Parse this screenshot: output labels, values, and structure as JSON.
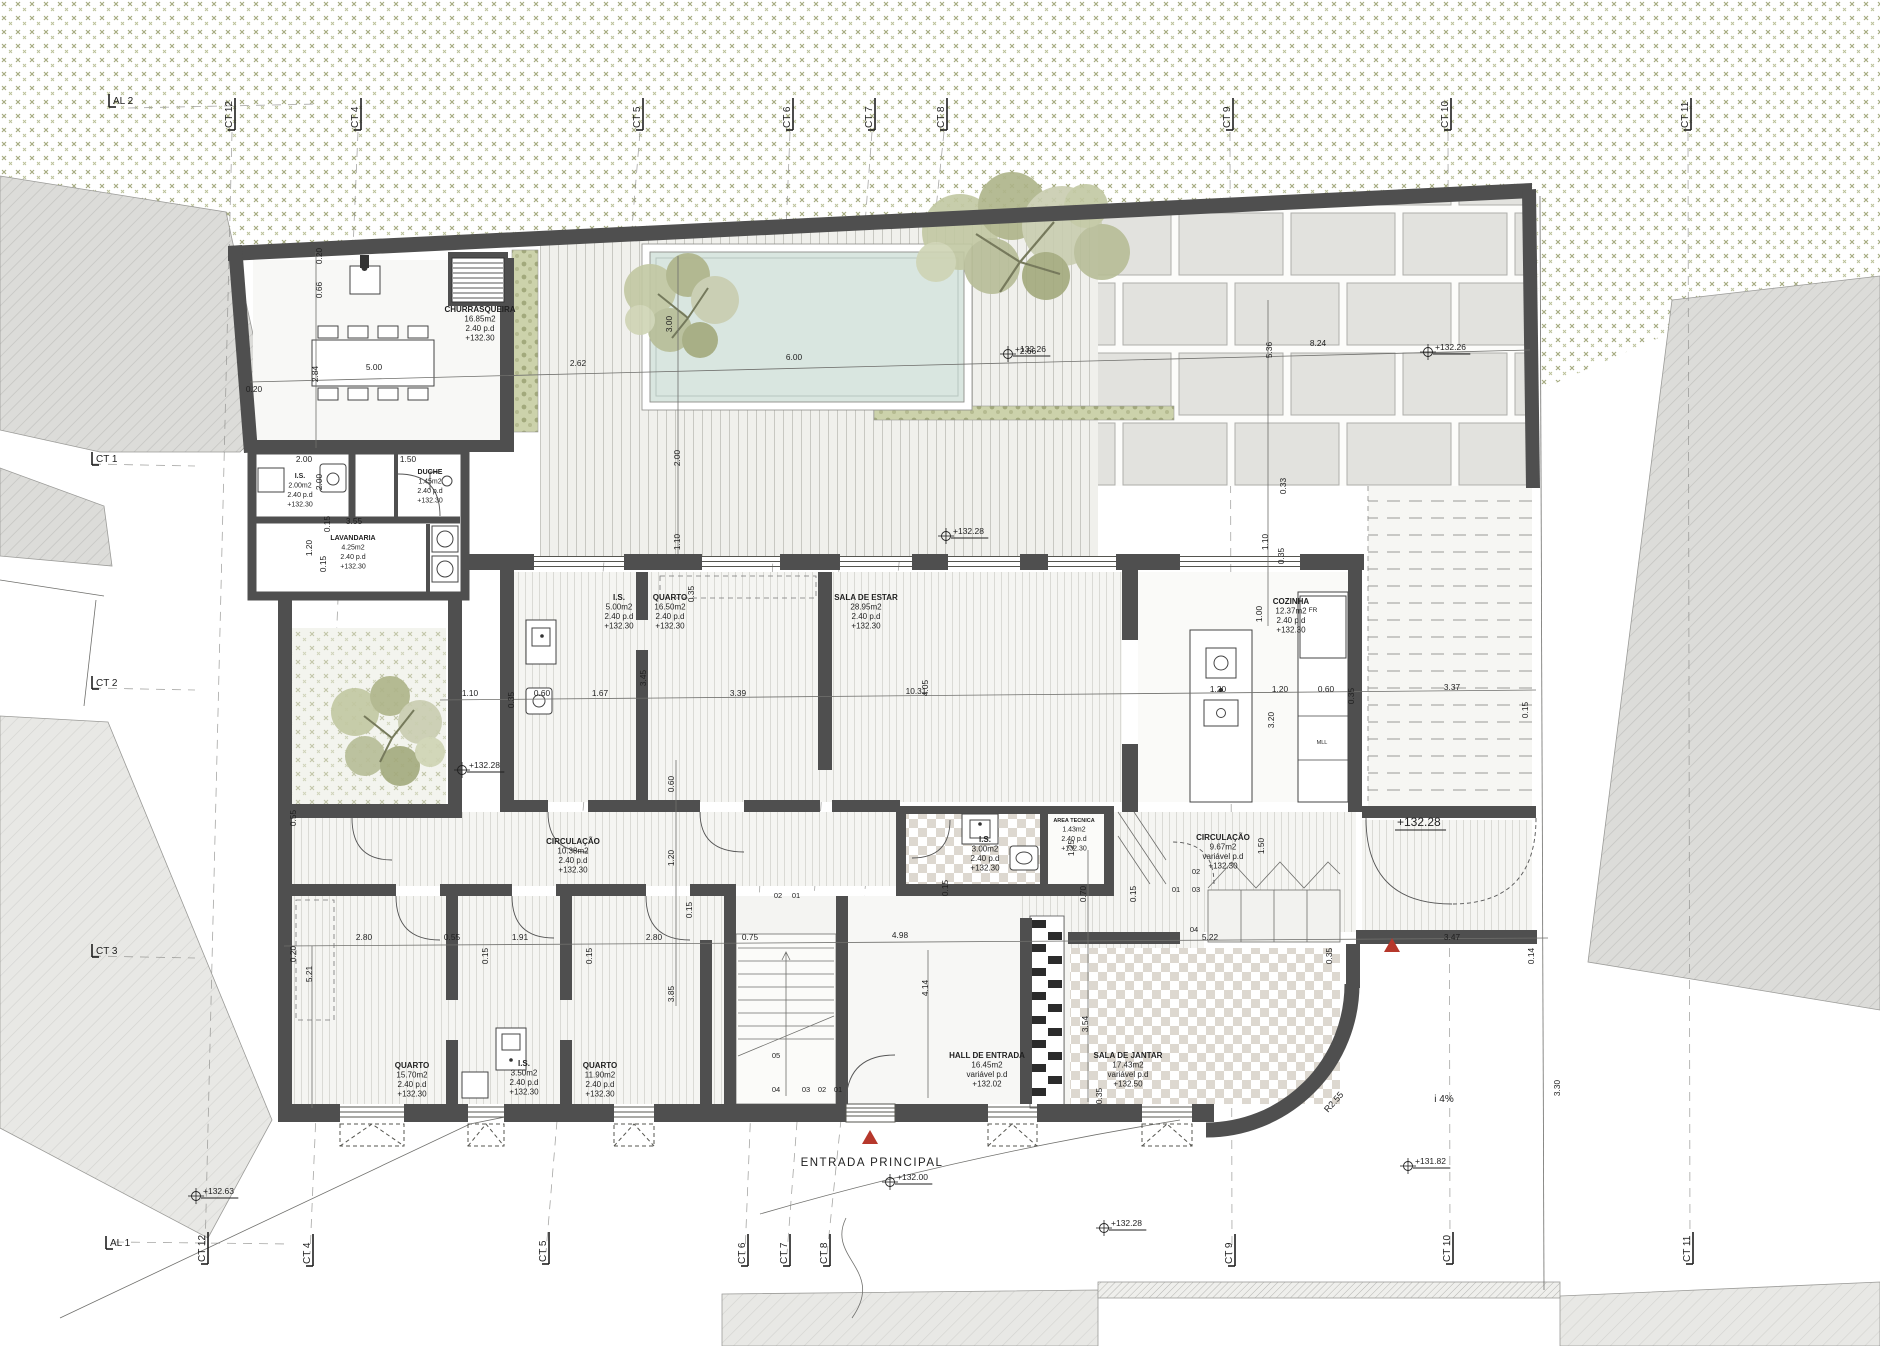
{
  "colors": {
    "vegetation": "#9ba172",
    "wall": "#4f4f4f",
    "pool": "#d9e6e0",
    "paving": "#e2e2de",
    "marker_red": "#b6372b",
    "text": "#1f1f1f"
  },
  "rooms": [
    {
      "name": "CHURRASQUEIRA",
      "area": "16.85m2",
      "height": "2.40 p.d",
      "level": "+132.30",
      "x": 480,
      "y": 312
    },
    {
      "name": "I.S.",
      "area": "2.00m2",
      "height": "2.40 p.d",
      "level": "+132.30",
      "x": 300,
      "y": 478,
      "small": true
    },
    {
      "name": "DUCHE",
      "area": "1.45m2",
      "height": "2.40 p.d",
      "level": "+132.30",
      "x": 430,
      "y": 474,
      "small": true
    },
    {
      "name": "LAVANDARIA",
      "area": "4.25m2",
      "height": "2.40 p.d",
      "level": "+132.30",
      "x": 353,
      "y": 540,
      "small": true
    },
    {
      "name": "I.S.",
      "area": "5.00m2",
      "height": "2.40 p.d",
      "level": "+132.30",
      "x": 619,
      "y": 600
    },
    {
      "name": "QUARTO",
      "area": "16.50m2",
      "height": "2.40 p.d",
      "level": "+132.30",
      "x": 670,
      "y": 600
    },
    {
      "name": "SALA DE ESTAR",
      "area": "28.95m2",
      "height": "2.40 p.d",
      "level": "+132.30",
      "x": 866,
      "y": 600
    },
    {
      "name": "COZINHA",
      "area": "12.37m2",
      "height": "2.40 p.d",
      "level": "+132.30",
      "x": 1291,
      "y": 604
    },
    {
      "name": "CIRCULAÇÃO",
      "area": "10.38m2",
      "height": "2.40 p.d",
      "level": "+132.30",
      "x": 573,
      "y": 844
    },
    {
      "name": "I.S.",
      "area": "3.00m2",
      "height": "2.40 p.d",
      "level": "+132.30",
      "x": 985,
      "y": 842
    },
    {
      "name": "AREA TECNICA",
      "area": "1.43m2",
      "height": "2.40 p.d",
      "level": "+132.30",
      "x": 1074,
      "y": 822,
      "small": true
    },
    {
      "name": "CIRCULAÇÃO",
      "area": "9.67m2",
      "height": "variável p.d",
      "level": "+132.30",
      "x": 1223,
      "y": 840
    },
    {
      "name": "QUARTO",
      "area": "15.70m2",
      "height": "2.40 p.d",
      "level": "+132.30",
      "x": 412,
      "y": 1068
    },
    {
      "name": "I.S.",
      "area": "3.50m2",
      "height": "2.40 p.d",
      "level": "+132.30",
      "x": 524,
      "y": 1066
    },
    {
      "name": "QUARTO",
      "area": "11.90m2",
      "height": "2.40 p.d",
      "level": "+132.30",
      "x": 600,
      "y": 1068
    },
    {
      "name": "HALL DE ENTRADA",
      "area": "16.45m2",
      "height": "variável p.d",
      "level": "+132.02",
      "x": 987,
      "y": 1058
    },
    {
      "name": "SALA DE JANTAR",
      "area": "17.43m2",
      "height": "variável p.d",
      "level": "+132.50",
      "x": 1128,
      "y": 1058
    }
  ],
  "grid_labels": [
    {
      "t": "AL 2",
      "x": 113,
      "y": 104,
      "o": "h"
    },
    {
      "t": "CT 12",
      "x": 232,
      "y": 128,
      "o": "v"
    },
    {
      "t": "CT 4",
      "x": 358,
      "y": 128,
      "o": "v"
    },
    {
      "t": "CT 5",
      "x": 640,
      "y": 128,
      "o": "v"
    },
    {
      "t": "CT 6",
      "x": 790,
      "y": 128,
      "o": "v"
    },
    {
      "t": "CT 7",
      "x": 872,
      "y": 128,
      "o": "v"
    },
    {
      "t": "CT 8",
      "x": 944,
      "y": 128,
      "o": "v"
    },
    {
      "t": "CT 9",
      "x": 1230,
      "y": 128,
      "o": "v"
    },
    {
      "t": "CT 10",
      "x": 1448,
      "y": 128,
      "o": "v"
    },
    {
      "t": "CT 11",
      "x": 1688,
      "y": 128,
      "o": "v"
    },
    {
      "t": "CT 1",
      "x": 96,
      "y": 462,
      "o": "h"
    },
    {
      "t": "CT 2",
      "x": 96,
      "y": 686,
      "o": "h"
    },
    {
      "t": "CT 3",
      "x": 96,
      "y": 954,
      "o": "h"
    },
    {
      "t": "AL 1",
      "x": 110,
      "y": 1246,
      "o": "h"
    },
    {
      "t": "CT 12",
      "x": 205,
      "y": 1262,
      "o": "v"
    },
    {
      "t": "CT 4",
      "x": 310,
      "y": 1264,
      "o": "v"
    },
    {
      "t": "CT 5",
      "x": 546,
      "y": 1262,
      "o": "v"
    },
    {
      "t": "CT 6",
      "x": 745,
      "y": 1264,
      "o": "v"
    },
    {
      "t": "CT 7",
      "x": 787,
      "y": 1264,
      "o": "v"
    },
    {
      "t": "CT 8",
      "x": 827,
      "y": 1264,
      "o": "v"
    },
    {
      "t": "CT 9",
      "x": 1232,
      "y": 1264,
      "o": "v"
    },
    {
      "t": "CT 10",
      "x": 1450,
      "y": 1262,
      "o": "v"
    },
    {
      "t": "CT 11",
      "x": 1690,
      "y": 1262,
      "o": "v"
    }
  ],
  "elevations": [
    {
      "t": "+132.26",
      "x": 1008,
      "y": 354
    },
    {
      "t": "+132.26",
      "x": 1428,
      "y": 352
    },
    {
      "t": "+132.28",
      "x": 946,
      "y": 536
    },
    {
      "t": "+132.28",
      "x": 462,
      "y": 770
    },
    {
      "t": "+132.28",
      "x": 1390,
      "y": 828,
      "big": true
    },
    {
      "t": "+132.63",
      "x": 196,
      "y": 1196
    },
    {
      "t": "+132.00",
      "x": 890,
      "y": 1182
    },
    {
      "t": "+132.28",
      "x": 1104,
      "y": 1228
    },
    {
      "t": "+131.82",
      "x": 1408,
      "y": 1166
    }
  ],
  "annotations": [
    {
      "t": "ENTRADA PRINCIPAL",
      "x": 872,
      "y": 1166,
      "s": 11.5,
      "sp": 1.5
    },
    {
      "t": "i 4%",
      "x": 1444,
      "y": 1102,
      "s": 10
    },
    {
      "t": "R2.55",
      "x": 1336,
      "y": 1104,
      "s": 9,
      "r": -48
    },
    {
      "t": "FR",
      "x": 1313,
      "y": 612,
      "s": 6.5
    },
    {
      "t": "MLL",
      "x": 1322,
      "y": 744,
      "s": 5.5
    },
    {
      "t": "02",
      "x": 778,
      "y": 898,
      "s": 7.5
    },
    {
      "t": "01",
      "x": 796,
      "y": 898,
      "s": 7.5
    },
    {
      "t": "02",
      "x": 1196,
      "y": 874,
      "s": 7.5
    },
    {
      "t": "01",
      "x": 1176,
      "y": 892,
      "s": 7.5
    },
    {
      "t": "03",
      "x": 1196,
      "y": 892,
      "s": 7.5
    },
    {
      "t": "05",
      "x": 776,
      "y": 1058,
      "s": 7.5
    },
    {
      "t": "04",
      "x": 776,
      "y": 1092,
      "s": 7.5
    },
    {
      "t": "03",
      "x": 806,
      "y": 1092,
      "s": 7.5
    },
    {
      "t": "02",
      "x": 822,
      "y": 1092,
      "s": 7.5
    },
    {
      "t": "01",
      "x": 838,
      "y": 1092,
      "s": 7.5
    },
    {
      "t": "04",
      "x": 1194,
      "y": 932,
      "s": 7.5
    }
  ],
  "dimensions": [
    {
      "t": "0.20",
      "x": 254,
      "y": 392
    },
    {
      "t": "5.00",
      "x": 374,
      "y": 370
    },
    {
      "t": "2.84",
      "x": 318,
      "y": 374,
      "r": -90
    },
    {
      "t": "2.62",
      "x": 578,
      "y": 366
    },
    {
      "t": "6.00",
      "x": 794,
      "y": 360
    },
    {
      "t": "2.66",
      "x": 1028,
      "y": 354
    },
    {
      "t": "8.24",
      "x": 1318,
      "y": 346
    },
    {
      "t": "0.20",
      "x": 322,
      "y": 256,
      "r": -90
    },
    {
      "t": "0.66",
      "x": 322,
      "y": 290,
      "r": -90
    },
    {
      "t": "3.00",
      "x": 672,
      "y": 324,
      "r": -90
    },
    {
      "t": "5.36",
      "x": 1272,
      "y": 350,
      "r": -90
    },
    {
      "t": "0.33",
      "x": 1286,
      "y": 486,
      "r": -90
    },
    {
      "t": "2.00",
      "x": 680,
      "y": 458,
      "r": -90
    },
    {
      "t": "1.10",
      "x": 680,
      "y": 542,
      "r": -90
    },
    {
      "t": "1.10",
      "x": 1268,
      "y": 542,
      "r": -90
    },
    {
      "t": "0.35",
      "x": 1284,
      "y": 556,
      "r": -90
    },
    {
      "t": "1.00",
      "x": 1262,
      "y": 614,
      "r": -90
    },
    {
      "t": "2.00",
      "x": 304,
      "y": 462
    },
    {
      "t": "1.50",
      "x": 408,
      "y": 462
    },
    {
      "t": "2.00",
      "x": 322,
      "y": 482,
      "r": -90
    },
    {
      "t": "3.55",
      "x": 354,
      "y": 524
    },
    {
      "t": "0.15",
      "x": 330,
      "y": 524,
      "r": -90
    },
    {
      "t": "1.20",
      "x": 312,
      "y": 548,
      "r": -90
    },
    {
      "t": "0.15",
      "x": 326,
      "y": 564,
      "r": -90
    },
    {
      "t": "1.10",
      "x": 470,
      "y": 696
    },
    {
      "t": "0.35",
      "x": 514,
      "y": 700,
      "r": -90
    },
    {
      "t": "0.60",
      "x": 542,
      "y": 696
    },
    {
      "t": "1.67",
      "x": 600,
      "y": 696
    },
    {
      "t": "3.45",
      "x": 646,
      "y": 678,
      "r": -90
    },
    {
      "t": "3.39",
      "x": 738,
      "y": 696
    },
    {
      "t": "10.31",
      "x": 916,
      "y": 694
    },
    {
      "t": "4.05",
      "x": 928,
      "y": 688,
      "r": -90
    },
    {
      "t": "1.20",
      "x": 1218,
      "y": 692
    },
    {
      "t": "1.20",
      "x": 1280,
      "y": 692
    },
    {
      "t": "0.60",
      "x": 1326,
      "y": 692
    },
    {
      "t": "0.35",
      "x": 1354,
      "y": 696,
      "r": -90
    },
    {
      "t": "3.37",
      "x": 1452,
      "y": 690
    },
    {
      "t": "0.15",
      "x": 1528,
      "y": 710,
      "r": -90
    },
    {
      "t": "3.20",
      "x": 1274,
      "y": 720,
      "r": -90
    },
    {
      "t": "0.35",
      "x": 694,
      "y": 594,
      "r": -90
    },
    {
      "t": "0.60",
      "x": 674,
      "y": 784,
      "r": -90
    },
    {
      "t": "1.20",
      "x": 674,
      "y": 858,
      "r": -90
    },
    {
      "t": "0.15",
      "x": 692,
      "y": 910,
      "r": -90
    },
    {
      "t": "3.85",
      "x": 674,
      "y": 994,
      "r": -90
    },
    {
      "t": "0.55",
      "x": 296,
      "y": 818,
      "r": -90
    },
    {
      "t": "1.50",
      "x": 1264,
      "y": 846,
      "r": -90
    },
    {
      "t": "1.25",
      "x": 1074,
      "y": 848,
      "r": -90
    },
    {
      "t": "0.20",
      "x": 296,
      "y": 954,
      "r": -90
    },
    {
      "t": "2.80",
      "x": 364,
      "y": 940
    },
    {
      "t": "0.55",
      "x": 452,
      "y": 940
    },
    {
      "t": "1.91",
      "x": 520,
      "y": 940
    },
    {
      "t": "0.15",
      "x": 488,
      "y": 956,
      "r": -90
    },
    {
      "t": "0.15",
      "x": 592,
      "y": 956,
      "r": -90
    },
    {
      "t": "2.80",
      "x": 654,
      "y": 940
    },
    {
      "t": "0.75",
      "x": 750,
      "y": 940
    },
    {
      "t": "4.98",
      "x": 900,
      "y": 938
    },
    {
      "t": "5.22",
      "x": 1210,
      "y": 940
    },
    {
      "t": "0.35",
      "x": 1332,
      "y": 956,
      "r": -90
    },
    {
      "t": "3.47",
      "x": 1452,
      "y": 940
    },
    {
      "t": "0.14",
      "x": 1534,
      "y": 956,
      "r": -90
    },
    {
      "t": "5.21",
      "x": 312,
      "y": 974,
      "r": -90
    },
    {
      "t": "4.14",
      "x": 928,
      "y": 988,
      "r": -90
    },
    {
      "t": "3.54",
      "x": 1088,
      "y": 1024,
      "r": -90
    },
    {
      "t": "0.35",
      "x": 1102,
      "y": 1096,
      "r": -90
    },
    {
      "t": "0.70",
      "x": 1086,
      "y": 894,
      "r": -90
    },
    {
      "t": "0.15",
      "x": 1136,
      "y": 894,
      "r": -90
    },
    {
      "t": "0.15",
      "x": 948,
      "y": 888,
      "r": -90
    },
    {
      "t": "3.30",
      "x": 1560,
      "y": 1088,
      "r": -90
    }
  ]
}
